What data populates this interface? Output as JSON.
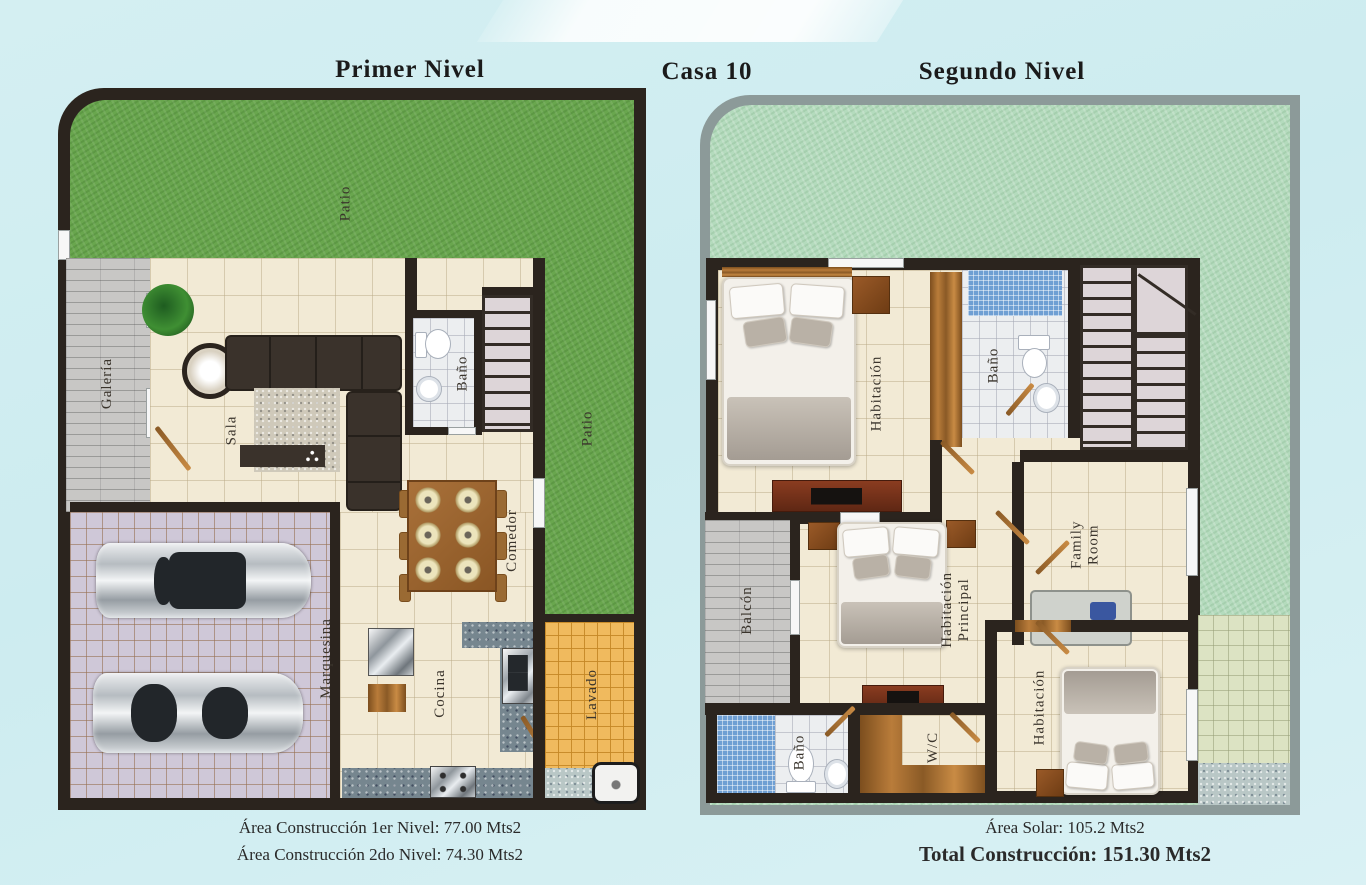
{
  "titles": {
    "first_floor": "Primer Nivel",
    "house": "Casa 10",
    "second_floor": "Segundo Nivel"
  },
  "first_floor": {
    "rooms": {
      "patio_top": "Patio",
      "patio_right": "Patio",
      "galeria": "Galería",
      "sala": "Sala",
      "bano": "Baño",
      "comedor": "Comedor",
      "marquesina": "Marquesina",
      "cocina": "Cocina",
      "lavado": "Lavado"
    },
    "area_line1": "Área Construcción 1er Nivel: 77.00 Mts2",
    "area_line2": "Área Construcción 2do Nivel: 74.30 Mts2"
  },
  "second_floor": {
    "rooms": {
      "habitacion_top": "Habitación",
      "bano_top": "Baño",
      "family_room": "Family Room",
      "balcon": "Balcón",
      "habitacion_principal": "Habitación Principal",
      "wc": "W/C",
      "bano_bottom": "Baño",
      "habitacion_bottom": "Habitación"
    },
    "area_line1": "Área Solar: 105.2 Mts2",
    "area_line2": "Total Construcción: 151.30 Mts2"
  },
  "colors": {
    "background": "#cdecf0",
    "wall_dark": "#2b241e",
    "grass_bright": "#69a64e",
    "grass_pale": "#b4dbbd",
    "floor_beige": "#f2ead5",
    "garage_tile": "#cfc8d8",
    "laundry_tile": "#f0ba5e",
    "shower_mosaic": "#6f9fd3",
    "plank_gray": "#c8c7c5",
    "terrace_tile": "#dce3c3",
    "border_gray": "#8c9a99",
    "wood_brown": "#b97c3a"
  }
}
